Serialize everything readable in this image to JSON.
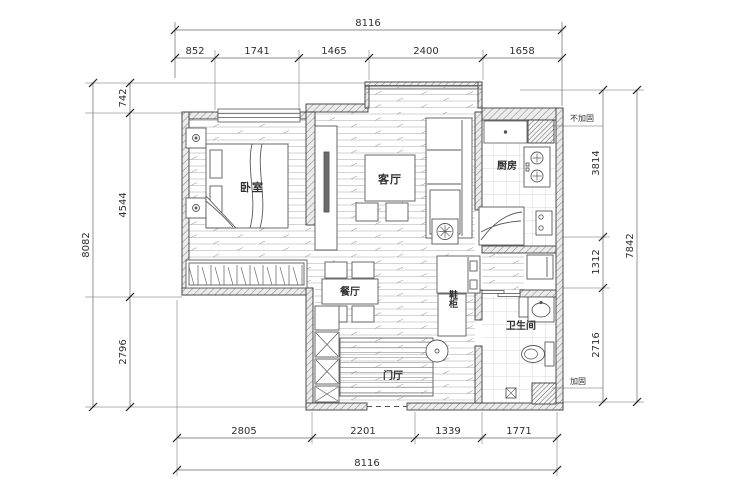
{
  "plan": {
    "rooms": {
      "bedroom": "卧室",
      "living_room": "客厅",
      "kitchen": "厨房",
      "dining_room": "餐厅",
      "bathroom": "卫生间",
      "entry_hall": "门厅",
      "shoe_cabinet": "鞋柜"
    },
    "annotations": {
      "not_reinforced": "不加固",
      "reinforced": "加固"
    },
    "dims": {
      "top": {
        "total": "8116",
        "segments": [
          "852",
          "1741",
          "1465",
          "2400",
          "1658"
        ]
      },
      "bottom": {
        "total": "8116",
        "segments": [
          "2805",
          "2201",
          "1339",
          "1771"
        ]
      },
      "left": {
        "total": "8082",
        "segments": [
          "742",
          "4544",
          "2796"
        ]
      },
      "right": {
        "total": "7842",
        "segments": [
          "3814",
          "1312",
          "2716"
        ]
      }
    },
    "colors": {
      "background": "#ffffff",
      "line": "#4a4a4a",
      "wall": "#3c3c3c",
      "text": "#2f2f2f"
    }
  }
}
